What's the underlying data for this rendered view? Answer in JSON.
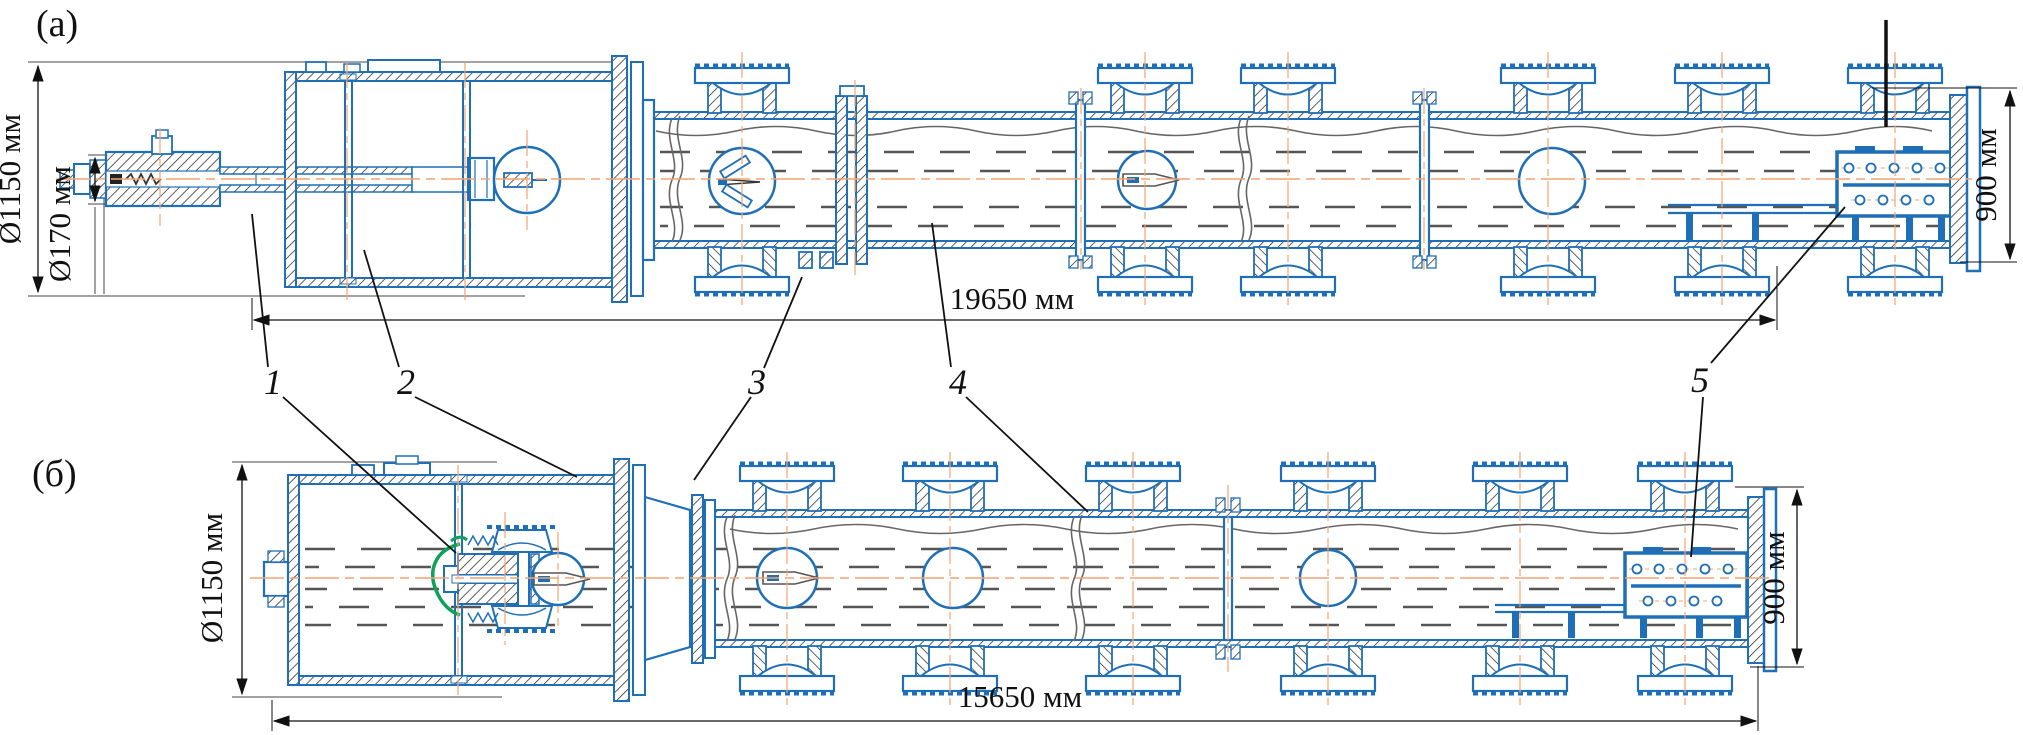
{
  "figure": {
    "panels": {
      "a": {
        "label": "(a)",
        "dim_outer_diameter": "Ø1150 мм",
        "dim_inner_diameter": "Ø170 мм",
        "dim_length": "19650 мм",
        "dim_end_height": "900 мм"
      },
      "b": {
        "label": "(б)",
        "dim_outer_diameter": "Ø1150 мм",
        "dim_length": "15650 мм",
        "dim_end_height": "900 мм"
      }
    },
    "callouts": [
      {
        "number": "1"
      },
      {
        "number": "2"
      },
      {
        "number": "3"
      },
      {
        "number": "4"
      },
      {
        "number": "5"
      }
    ],
    "colors": {
      "outline_blue": "#1E6FB8",
      "centerline_orange": "#F2A470",
      "hatch_black": "#1A1A1A",
      "cable_green": "#0FA05A",
      "interior_gray": "#555555",
      "dimension_black": "#111111"
    }
  }
}
